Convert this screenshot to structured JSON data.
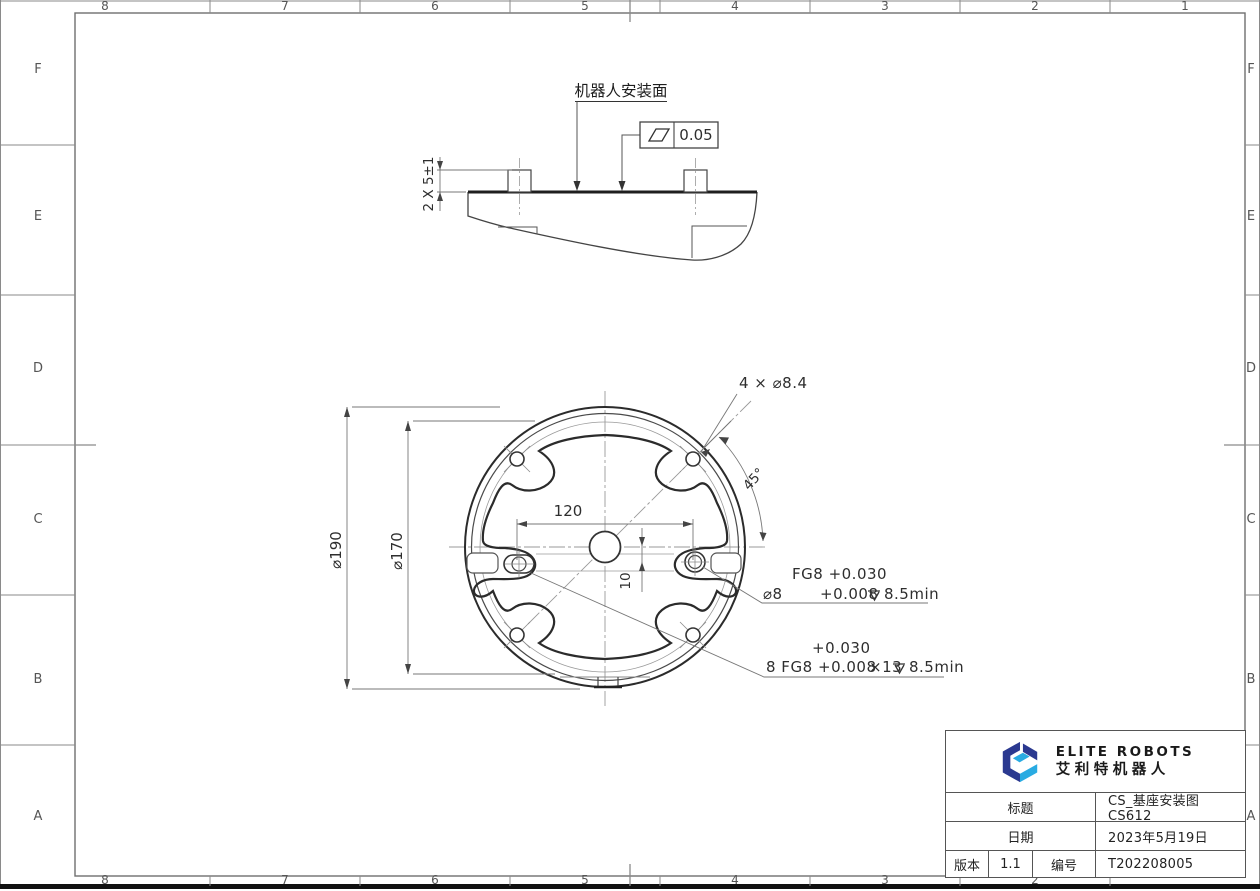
{
  "border": {
    "top_labels": [
      "8",
      "7",
      "6",
      "5",
      "4",
      "3",
      "2",
      "1"
    ],
    "bottom_labels": [
      "8",
      "7",
      "6",
      "5",
      "4",
      "3",
      "2"
    ],
    "left_labels": [
      "F",
      "E",
      "D",
      "C",
      "B",
      "A"
    ],
    "right_labels": [
      "F",
      "E",
      "D",
      "C",
      "B",
      "A"
    ]
  },
  "side_view": {
    "surface_label": "机器人安装面",
    "flatness_tolerance": "0.05",
    "boss_height_dim": "2 X 5±1"
  },
  "front_view": {
    "outer_diameter": "⌀190",
    "bolt_circle_diameter": "⌀170",
    "hole_spacing": "120",
    "offset": "10",
    "angle": "45°",
    "mount_holes_label": "4 × ⌀8.4",
    "pin_hole_note": {
      "line1": "FG8 +0.030",
      "dia": "⌀8",
      "tolerance": "+0.008",
      "depth": "8.5min"
    },
    "slot_note": {
      "upper_tolerance": "+0.030",
      "prefix": "8 FG8",
      "lower_tolerance": "+0.008",
      "length": "×13",
      "depth": "8.5min"
    }
  },
  "title_block": {
    "brand": {
      "name": "ELITE ROBOTS",
      "name_cn": "艾利特机器人",
      "navy": "#2b3990",
      "cyan": "#29abe2"
    },
    "title_label": "标题",
    "title_value": "CS_基座安装图 CS612",
    "date_label": "日期",
    "date_value": "2023年5月19日",
    "version_label": "版本",
    "version_value": "1.1",
    "number_label": "编号",
    "number_value": "T202208005"
  }
}
